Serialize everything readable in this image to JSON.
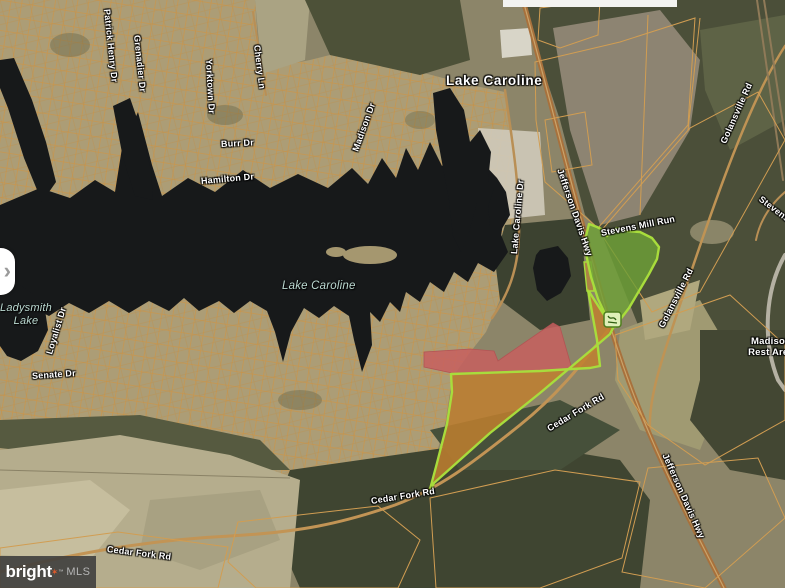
{
  "map": {
    "town": "Lake Caroline",
    "water_labels": {
      "lake_caroline": "Lake Caroline",
      "ladysmith_line1": "Ladysmith",
      "ladysmith_line2": "Lake"
    },
    "roads": {
      "patrick_henry": "Patrick Henry Dr",
      "grenadier": "Grenadier Dr",
      "yorktown": "Yorktown Dr",
      "cherry": "Cherry Ln",
      "burr": "Burr Dr",
      "hamilton": "Hamilton Dr",
      "madison": "Madison Dr",
      "loyalist": "Loyalist Dr",
      "senate": "Senate Dr",
      "lake_caroline_dr": "Lake Caroline Dr",
      "jefferson_davis_upper": "Jefferson Davis Hwy",
      "jefferson_davis_lower": "Jefferson Davis Hwy",
      "golansville_upper": "Golansville Rd",
      "golansville_lower": "Golansville Rd",
      "stevens_mill_run": "Stevens Mill Run",
      "stevens_edge": "Stevens",
      "cedar_fork_upper": "Cedar Fork Rd",
      "cedar_fork_mid": "Cedar Fork Rd",
      "cedar_fork_bottom": "Cedar Fork Rd"
    },
    "poi": {
      "madison_rest_line1": "Madison",
      "madison_rest_line2": "Rest Area"
    },
    "icons": {
      "parcel_marker": "green-parcel-marker",
      "chevron_right": "›"
    },
    "colors": {
      "highlight_outline_green": "#a8dc3c",
      "subject_parcel_orange": "#be8034",
      "overlay_parcel_red": "#c75f5f",
      "lot_boundary_orange": "#c8964e",
      "water_dark": "#17191a"
    }
  },
  "branding": {
    "name": "bright",
    "star": "✶",
    "trademark": "™",
    "suffix": "MLS"
  }
}
